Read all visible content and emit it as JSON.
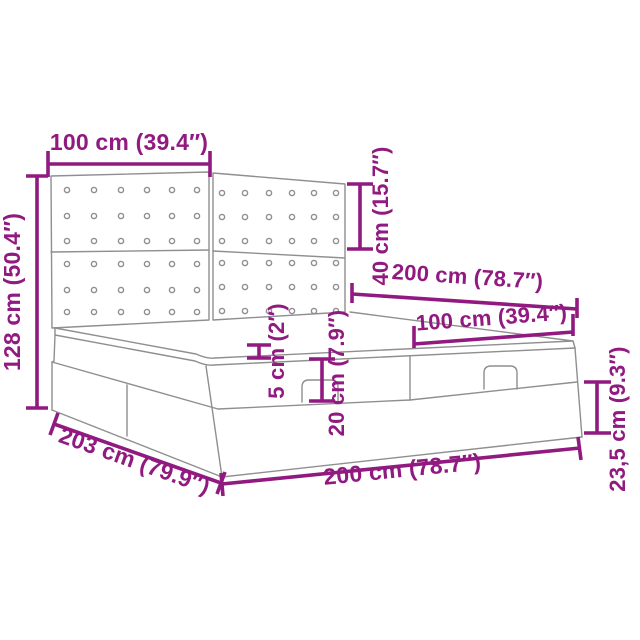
{
  "diagram": {
    "title": "Ottoman bed dimension diagram",
    "accent_color": "#911a80",
    "line_color": "#8f8f8f",
    "background_color": "#ffffff",
    "labels": {
      "headboard_half_width": "100 cm (39.4″)",
      "headboard_panel_height": "40 cm (15.7″)",
      "total_height": "128 cm (50.4″)",
      "bed_width_top": "200 cm (78.7″)",
      "ottoman_section_width": "100 cm (39.4″)",
      "topper_thickness": "5 cm (2″)",
      "mattress_height": "20 cm (7.9″)",
      "bed_length": "203 cm (79.9″)",
      "bed_width_bottom": "200 cm (78.7″)",
      "base_height": "23,5 cm (9.3″)"
    },
    "measurements_cm": {
      "headboard_half_width": 100,
      "headboard_panel_height": 40,
      "total_height": 128,
      "bed_width": 200,
      "ottoman_section_width": 100,
      "topper_thickness": 5,
      "mattress_height": 20,
      "bed_length": 203,
      "base_height": 23.5
    }
  }
}
